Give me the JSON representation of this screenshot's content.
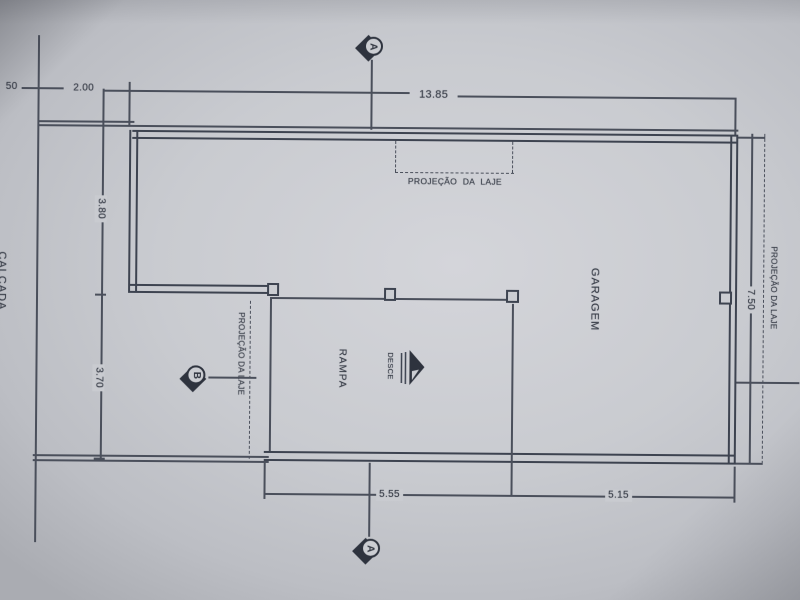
{
  "labels": {
    "calcada": "CALÇADA",
    "garagem": "GARAGEM",
    "rampa": "RAMPA",
    "desce": "DESCE",
    "projecao_top": "PROJEÇÃO DA LAJE",
    "projecao_left": "PROJEÇÃO DA LAJE",
    "projecao_right": "PROJEÇÃO DA LAJE"
  },
  "dims": {
    "lot_edge": "50",
    "setback": "2.00",
    "total_width": "13.85",
    "depth_upper": "3.80",
    "depth_lower": "3.70",
    "depth_total": "7.50",
    "bottom_left": "5.55",
    "bottom_right": "5.15"
  },
  "markers": {
    "a_top": "A",
    "a_bottom": "A",
    "b": "B"
  }
}
